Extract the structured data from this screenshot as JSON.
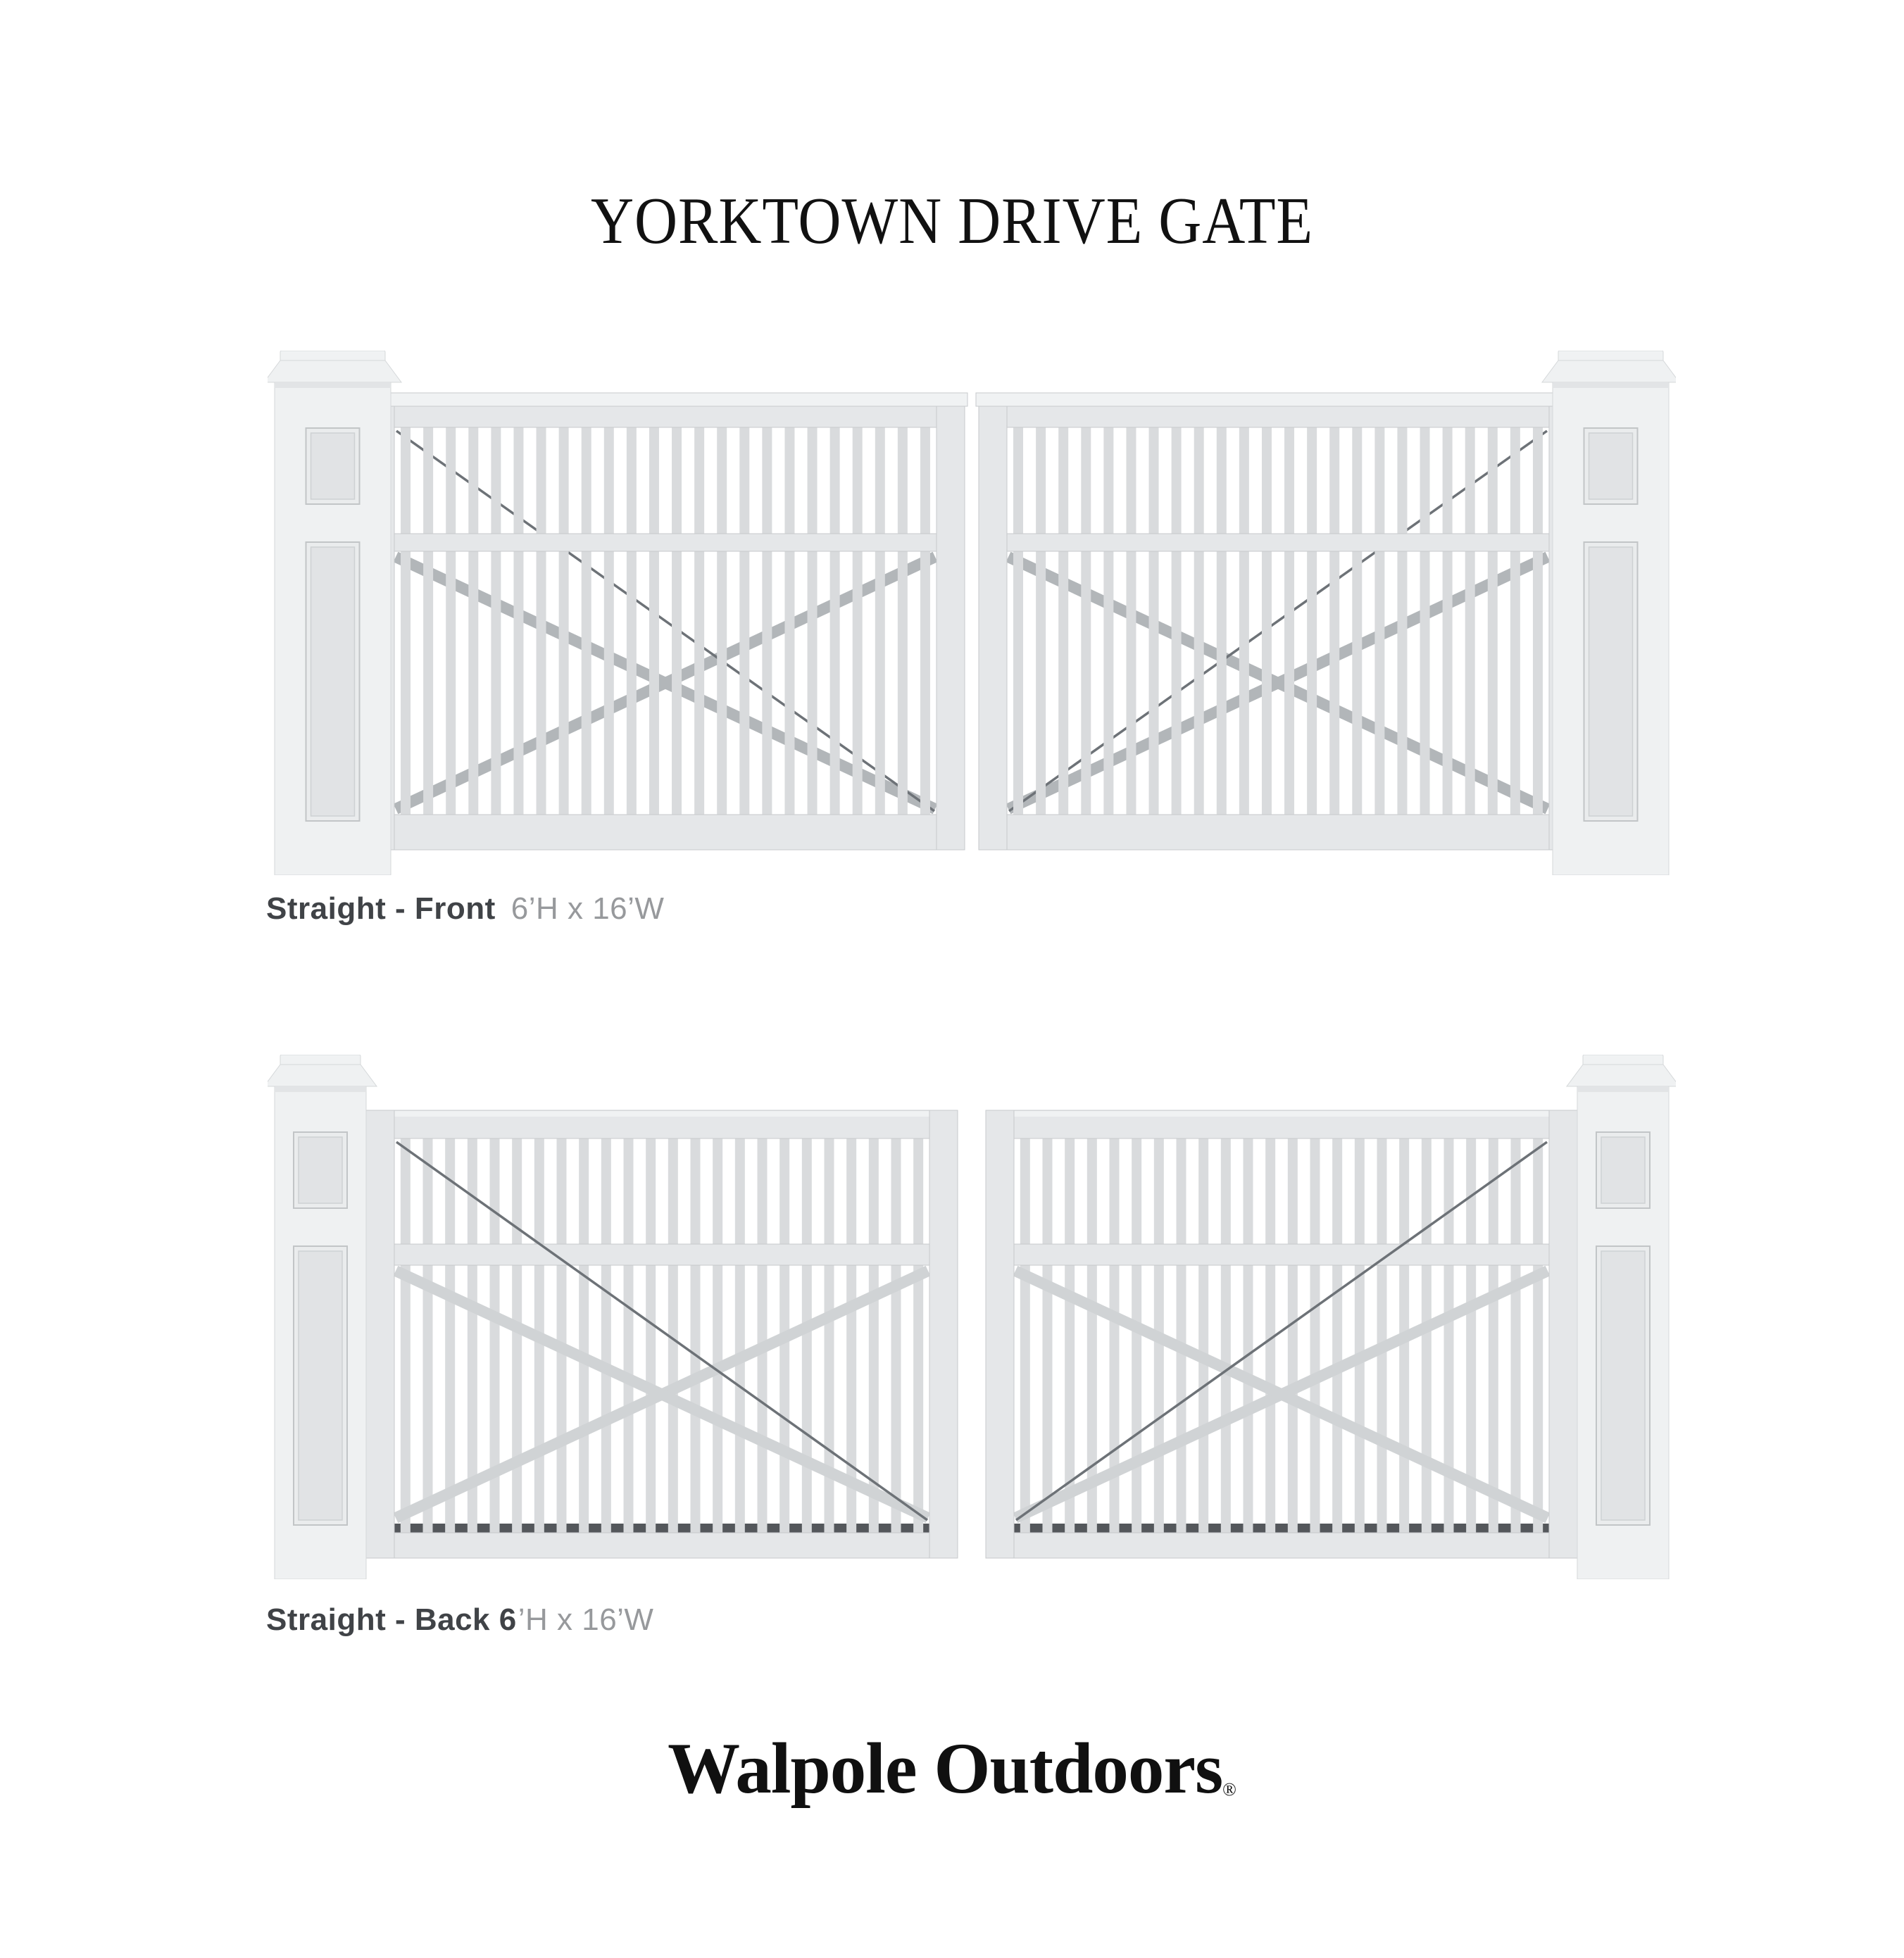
{
  "page": {
    "title": "YORKTOWN DRIVE GATE"
  },
  "figures": [
    {
      "view": "front",
      "caption_bold": "Straight - Front",
      "caption_dims": "6’H x 16’W"
    },
    {
      "view": "back",
      "caption_bold": "Straight - Back 6",
      "caption_dims": "’H x 16’W"
    }
  ],
  "brand": {
    "name": "Walpole Outdoors",
    "registered": "®"
  },
  "colors": {
    "title_color": "#111111",
    "caption_bold": "#404347",
    "caption_light": "#97999c",
    "brand_color": "#101010",
    "slat": "#d9dbdd",
    "frame": "#e5e7e9",
    "frame_edge": "#c7cacc",
    "molding": "#f0f2f3",
    "post": "#eff1f2",
    "post_edge": "#d5d8da",
    "post_shadow": "#e2e4e6",
    "panel_outer": "#eaeced",
    "panel_inner": "#e1e3e5",
    "panel_line": "#c2c5c7",
    "panel_line2": "#ced1d3",
    "brace_front": "#b2b6b9",
    "brace_back": "#d0d3d5",
    "cable": "#6d7277",
    "comb": "#54575b",
    "hinge": "#767d84"
  }
}
